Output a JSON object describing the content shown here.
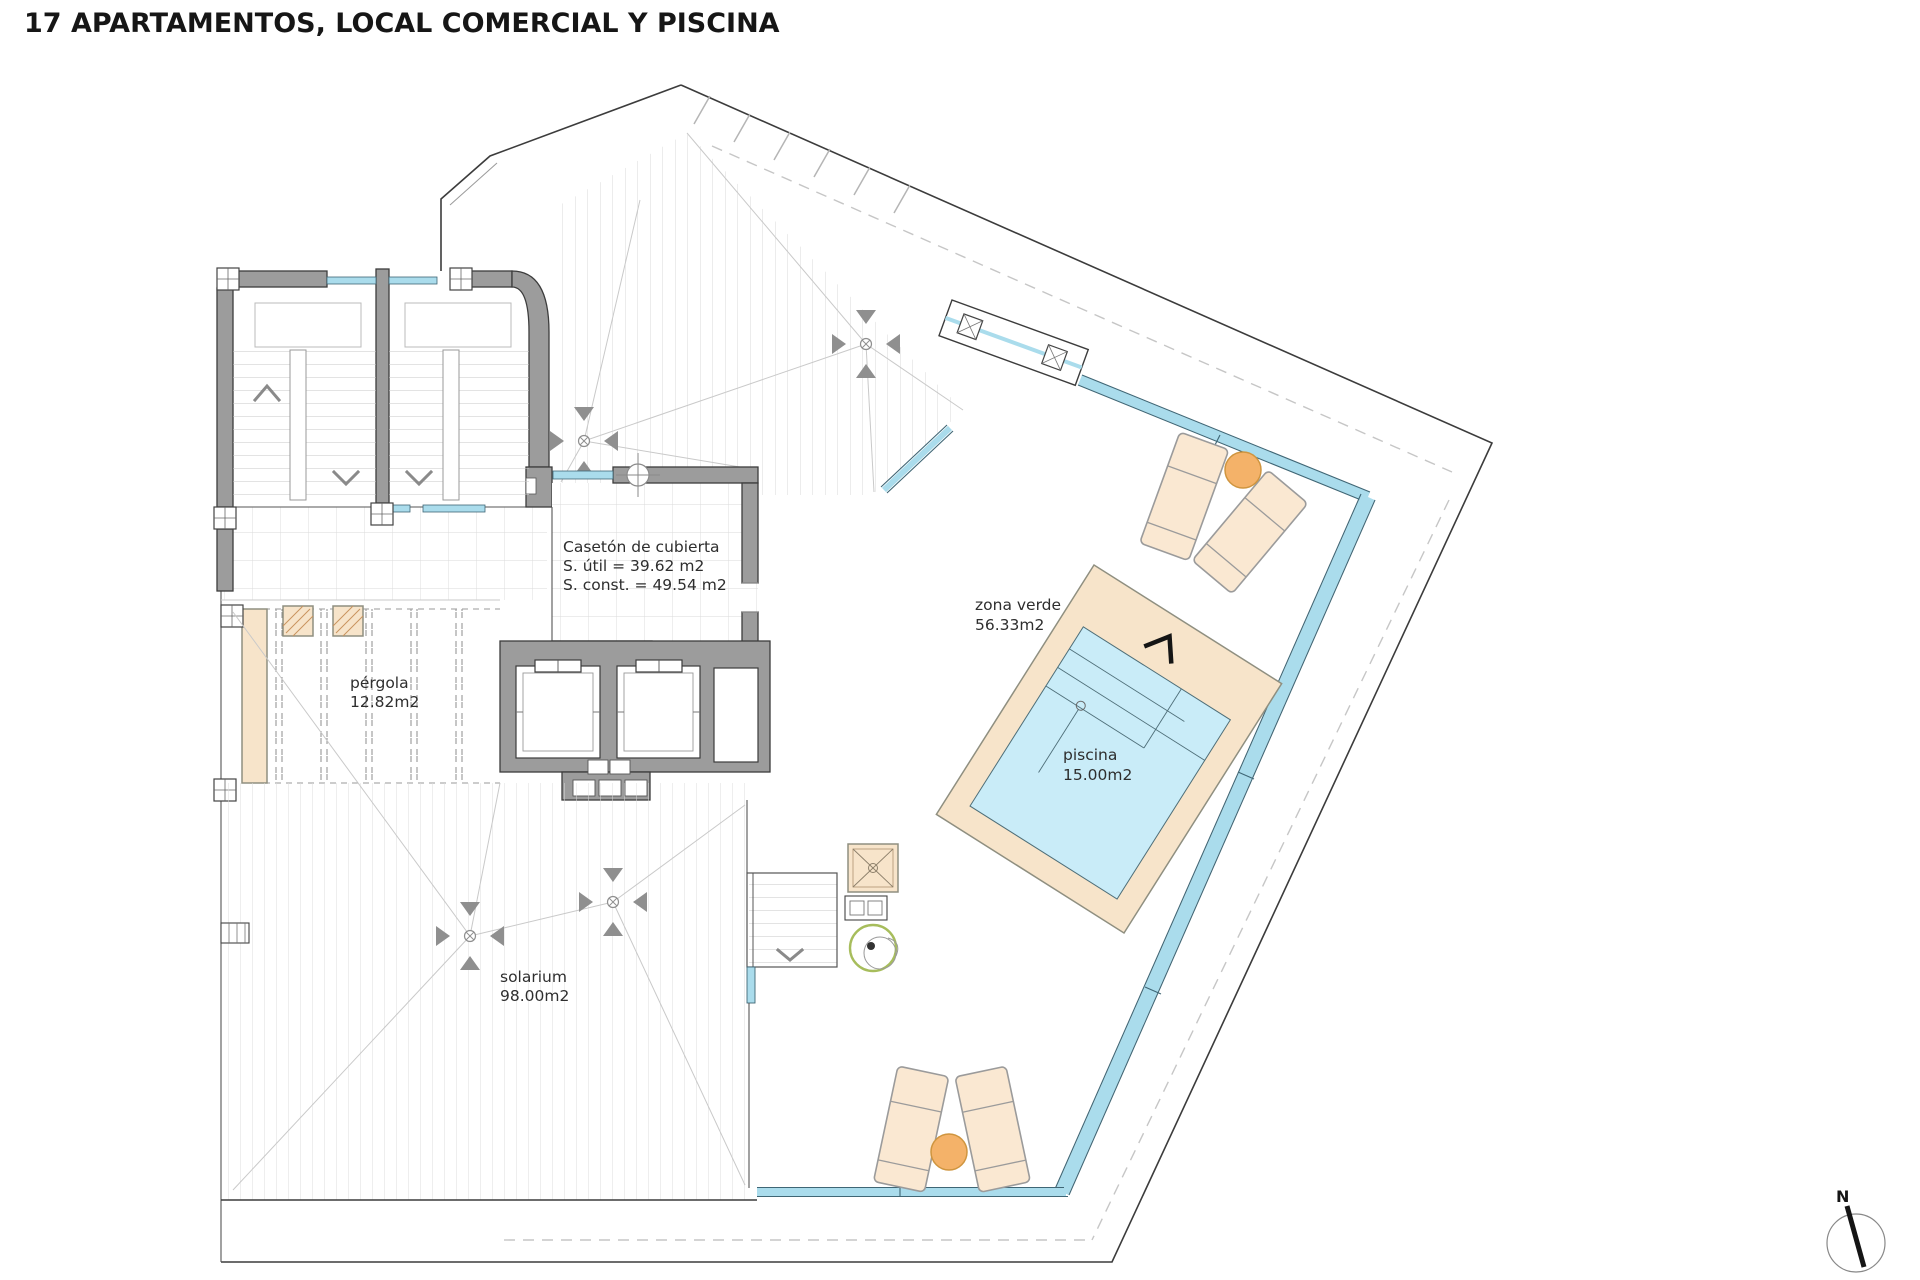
{
  "title": "17 APARTAMENTOS, LOCAL COMERCIAL Y PISCINA",
  "plan": {
    "rooms": {
      "caseton": {
        "name": "Casetón de cubierta",
        "area_util": "S. útil = 39.62 m2",
        "area_const": "S. const. = 49.54 m2"
      },
      "zona_verde": {
        "name": "zona verde",
        "area": "56.33m2"
      },
      "piscina": {
        "name": "piscina",
        "area": "15.00m2"
      },
      "pergola": {
        "name": "pérgola",
        "area": "12.82m2"
      },
      "solarium": {
        "name": "solarium",
        "area": "98.00m2"
      }
    },
    "compass": {
      "north_label": "N"
    }
  },
  "colors": {
    "wall-gray": "#9c9c9c",
    "line-dark": "#3c3c3c",
    "hatch-gray": "#d9d9d9",
    "deck-tan": "#f7e4ca",
    "pool-water": "#c9ecf8",
    "glass-blue": "#aadcec",
    "glass-edge": "#3f6675",
    "table-orange": "#f4b269",
    "lounger-tan": "#fae8d2",
    "plant-olive": "#a7bd5c"
  }
}
